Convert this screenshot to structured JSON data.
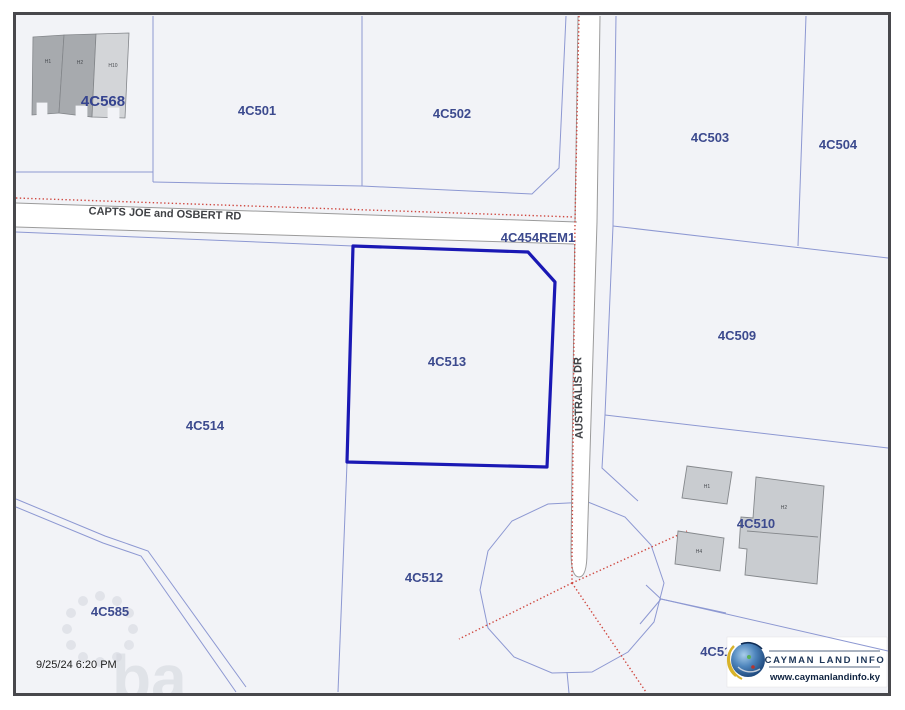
{
  "timestamp": "9/25/24 6:20 PM",
  "watermark_text": "ba",
  "roads": {
    "main": "CAPTS JOE and OSBERT RD",
    "side": "AUSTRALIS DR"
  },
  "parcels": {
    "p4c568": "4C568",
    "p4c501": "4C501",
    "p4c502": "4C502",
    "p4c503": "4C503",
    "p4c504": "4C504",
    "p4c454rem1": "4C454REM1",
    "p4c509": "4C509",
    "p4c513": "4C513",
    "p4c514": "4C514",
    "p4c510": "4C510",
    "p4c512": "4C512",
    "p4c585": "4C585",
    "p4c511": "4C511"
  },
  "highlighted_parcel": "4C513",
  "buildings": {
    "left1": "H1",
    "left2": "H2",
    "left3": "H10",
    "right1": "H1",
    "right2": "H2",
    "right4": "H4"
  },
  "logo": {
    "name": "CAYMAN LAND INFO",
    "url": "www.caymanlandinfo.ky"
  },
  "colors": {
    "highlight_outline": "#1a18b4",
    "parcel_line": "#8d98d2",
    "survey_dotted": "#cf4840",
    "road_edge": "#9b9b9b",
    "parcel_fill": "#f2f3f7",
    "label": "#3c4a8e"
  }
}
